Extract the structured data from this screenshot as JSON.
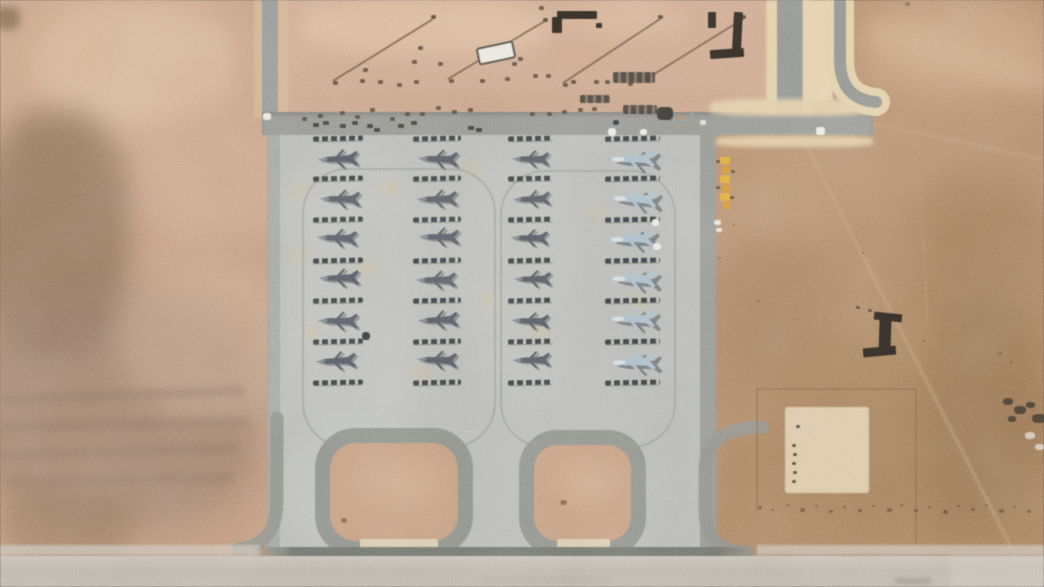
{
  "scene": {
    "width": 1044,
    "height": 587,
    "kind": "satellite-photo",
    "description": "Overhead satellite view of a desert airbase: a light-gray concrete apron holds four columns of six parked fighter jets (three columns of dark-gray jets, one column of light blue-gray jets), each with dark tie-down strips between rows; two rounded loop taxiways at the bottom; access roads and a dirt vehicle yard at top; open desert terrain around; runway band along the bottom edge.",
    "aircraft_total": 24,
    "aircraft_rows": 6,
    "aircraft_columns": 4
  },
  "palette": {
    "desert_left": "#c69b7c",
    "desert_right": "#ab7f5d",
    "dirt_yard": "#cfa487",
    "apron": "#b6b9b5",
    "apron_edge": "#8f928d",
    "road": "#8f918d",
    "road_cream": "#e4cfa4",
    "loop_ring": "#898c86",
    "loop_dirt": "#c59a79",
    "strip": "#2d3034",
    "jet_dark": "#4d545e",
    "jet_light": "#a8bccb",
    "runway_band": "#bab4a9",
    "crane_yellow": "#e0a82e"
  },
  "terrain": {
    "patches": [
      [
        30,
        0,
        210,
        130,
        "#d8b795",
        14,
        0.75,
        "45%"
      ],
      [
        140,
        110,
        150,
        130,
        "#cfa98a",
        16,
        0.6,
        "45%"
      ],
      [
        -20,
        110,
        150,
        250,
        "#7e604b",
        14,
        0.7,
        "40%"
      ],
      [
        -30,
        290,
        290,
        240,
        "#8f7260",
        18,
        0.65,
        "40%"
      ],
      [
        120,
        260,
        170,
        160,
        "#c9a688",
        14,
        0.55,
        "45%"
      ],
      [
        0,
        495,
        130,
        70,
        "#8a6a52",
        12,
        0.5,
        "40%"
      ],
      [
        -6,
        6,
        26,
        24,
        "#6f543f",
        4,
        0.7,
        "40%"
      ],
      [
        860,
        0,
        190,
        95,
        "#d0a77f",
        16,
        0.65,
        "45%"
      ],
      [
        910,
        170,
        140,
        170,
        "#96704f",
        18,
        0.5,
        "45%"
      ],
      [
        700,
        240,
        130,
        140,
        "#9f775a",
        16,
        0.45,
        "45%"
      ],
      [
        920,
        300,
        130,
        230,
        "#8d6949",
        18,
        0.5,
        "45%"
      ],
      [
        748,
        150,
        120,
        90,
        "#b8906d",
        12,
        0.5,
        "45%"
      ]
    ],
    "streaks": [
      [
        0,
        395,
        245,
        9,
        "#84695a",
        -2,
        4,
        0.5
      ],
      [
        0,
        423,
        250,
        8,
        "#84695a",
        -1,
        4,
        0.5
      ],
      [
        0,
        452,
        240,
        8,
        "#84695a",
        -2,
        4,
        0.45
      ],
      [
        8,
        478,
        225,
        8,
        "#84695a",
        -1,
        4,
        0.4
      ],
      [
        868,
        18,
        230,
        24,
        "#d7af88",
        16,
        10,
        0.55
      ]
    ],
    "tracks": [
      [
        806,
        143,
        473,
        63,
        2.5,
        "#c5a07c",
        0.5
      ],
      [
        918,
        140,
        182,
        87,
        2,
        "#b89271",
        0.4
      ],
      [
        873,
        122,
        172,
        12,
        3,
        "#c3a37e",
        0.35
      ]
    ],
    "speckles": [
      [
        712,
        242,
        3
      ],
      [
        718,
        257,
        3
      ],
      [
        709,
        269,
        2
      ],
      [
        757,
        300,
        3
      ],
      [
        733,
        224,
        2
      ],
      [
        905,
        2,
        5
      ],
      [
        922,
        340,
        3
      ],
      [
        862,
        252,
        2
      ],
      [
        998,
        352,
        4
      ],
      [
        1010,
        361,
        3
      ]
    ]
  },
  "yard": {
    "rect": [
      285,
      0,
      481,
      112
    ],
    "color": "#cfa487",
    "light_patches": [
      [
        300,
        0,
        250,
        55,
        "#e2c09e",
        10,
        0.7
      ],
      [
        560,
        0,
        130,
        40,
        "#dbb391",
        8,
        0.55
      ],
      [
        285,
        92,
        480,
        22,
        "#b98f70",
        8,
        0.35
      ]
    ],
    "lines": [
      [
        333,
        80,
        117,
        -31.8
      ],
      [
        448,
        78,
        113,
        -30.9
      ],
      [
        563,
        82,
        116,
        -33.4
      ],
      [
        643,
        80,
        118,
        -31.8
      ]
    ],
    "line_color": "#6a4f39",
    "line_end_dots": [
      [
        431,
        15
      ],
      [
        543,
        18
      ],
      [
        658,
        15
      ],
      [
        741,
        15
      ]
    ],
    "dots": [
      [
        333,
        81
      ],
      [
        360,
        79
      ],
      [
        378,
        80
      ],
      [
        397,
        83
      ],
      [
        414,
        80
      ],
      [
        449,
        79
      ],
      [
        480,
        79
      ],
      [
        505,
        77
      ],
      [
        563,
        83
      ],
      [
        571,
        80
      ],
      [
        594,
        80
      ],
      [
        605,
        80
      ],
      [
        628,
        82
      ],
      [
        412,
        60
      ],
      [
        418,
        46
      ],
      [
        438,
        62
      ],
      [
        363,
        68
      ],
      [
        512,
        62
      ],
      [
        518,
        57
      ],
      [
        533,
        74
      ],
      [
        546,
        74
      ],
      [
        302,
        117
      ],
      [
        318,
        114
      ],
      [
        340,
        111
      ],
      [
        355,
        115
      ],
      [
        370,
        108
      ],
      [
        390,
        117
      ],
      [
        405,
        112
      ],
      [
        420,
        112
      ],
      [
        436,
        106
      ],
      [
        452,
        110
      ],
      [
        468,
        108
      ],
      [
        530,
        112
      ],
      [
        547,
        112
      ],
      [
        562,
        110
      ],
      [
        578,
        108
      ],
      [
        592,
        107
      ],
      [
        539,
        6
      ]
    ],
    "white_vehicle": {
      "x": 477,
      "y": 44,
      "w": 34,
      "h": 14,
      "rot": -12
    },
    "equip_rows": [
      [
        580,
        95,
        30,
        8
      ],
      [
        623,
        105,
        34,
        9
      ],
      [
        613,
        72,
        42,
        11
      ]
    ],
    "dark_blob": [
      657,
      107,
      16,
      13
    ],
    "color_dots": [
      [
        680,
        116,
        "#d27c3a",
        4
      ],
      [
        690,
        113,
        "#9a948c",
        4
      ],
      [
        700,
        120,
        "#e7e4dc",
        6
      ],
      [
        677,
        126,
        "#d8b430",
        3
      ],
      [
        685,
        127,
        "#cf7a36",
        3
      ]
    ],
    "brackets": [
      [
        [
          557,
          11,
          40,
          8,
          0
        ],
        [
          552,
          17,
          10,
          16,
          0
        ],
        [
          596,
          23,
          6,
          5,
          0
        ]
      ],
      [
        [
          733,
          12,
          9,
          38,
          3
        ],
        [
          710,
          49,
          34,
          9,
          -4
        ],
        [
          708,
          12,
          8,
          16,
          0
        ]
      ]
    ],
    "bracket_color": "#26211a"
  },
  "roads": {
    "left_vertical_cream": [
      254,
      0,
      34,
      118
    ],
    "left_vertical_gray": [
      262,
      0,
      16,
      116
    ],
    "horizontal": [
      262,
      112,
      611,
      23
    ],
    "right1_cream": [
      766,
      0,
      46,
      114
    ],
    "right1_gray": [
      777,
      0,
      26,
      118
    ],
    "cream_mid": [
      803,
      0,
      30,
      102
    ],
    "cream_above": [
      710,
      99,
      163,
      17
    ],
    "cream_below": [
      716,
      136,
      157,
      11
    ],
    "white_dots": [
      [
        263,
        113,
        8,
        7
      ],
      [
        816,
        127,
        9,
        8
      ]
    ]
  },
  "apron": {
    "rect": [
      270,
      135,
      446,
      420
    ],
    "left_edge": [
      267,
      135,
      13,
      420
    ],
    "right_edge": [
      700,
      135,
      16,
      420
    ],
    "light_patches": [
      [
        288,
        140,
        130,
        300,
        "#c1c4bf",
        12,
        0.5
      ],
      [
        470,
        150,
        100,
        270,
        "#bfc2bd",
        12,
        0.45
      ],
      [
        286,
        425,
        150,
        125,
        "#c2c5c0",
        12,
        0.5
      ],
      [
        640,
        380,
        70,
        170,
        "#b0b3ae",
        10,
        0.4
      ]
    ],
    "warm_spots": [
      [
        300,
        190
      ],
      [
        390,
        188
      ],
      [
        368,
        268
      ],
      [
        300,
        255
      ],
      [
        472,
        168
      ],
      [
        596,
        213
      ],
      [
        640,
        300
      ],
      [
        420,
        372
      ],
      [
        540,
        332
      ],
      [
        310,
        332
      ],
      [
        488,
        300
      ]
    ],
    "warm_color": "#d9b87e",
    "guidelines": [
      [
        302,
        168,
        190,
        276,
        45
      ],
      [
        500,
        170,
        172,
        274,
        45
      ]
    ]
  },
  "paths": [
    [
      "M840,-6 L840,60 Q840,99 876,102",
      "#e4cfa4",
      28,
      1
    ],
    [
      "M840,-6 L840,60 Q840,99 876,102",
      "#8c8f8b",
      12,
      1
    ],
    [
      "M277,418 L277,500 Q277,546 238,549",
      "#898c86",
      13,
      0.95
    ],
    [
      "M762,427 Q705,428 705,470 L705,510 Q705,551 748,553",
      "#898c86",
      13,
      0.9
    ]
  ],
  "loops": {
    "ring_color": "#898c86",
    "dirt_color": "#c59a79",
    "notch_color": "#d9cbac",
    "items": [
      {
        "outer": [
          315,
          428,
          158,
          128
        ],
        "radius": 40,
        "ring": 15,
        "notch": [
          360,
          539,
          78,
          17
        ]
      },
      {
        "outer": [
          519,
          430,
          127,
          126
        ],
        "radius": 38,
        "ring": 15,
        "notch": [
          557,
          539,
          53,
          17
        ]
      }
    ],
    "dirt_specks": [
      [
        341,
        518,
        6,
        5
      ],
      [
        560,
        500,
        7,
        5
      ]
    ]
  },
  "aircraft": {
    "columns": [
      {
        "cx": 338,
        "kind": "dark",
        "w": 42,
        "h": 26,
        "sw": 50
      },
      {
        "cx": 437,
        "kind": "dark",
        "w": 42,
        "h": 26,
        "sw": 48
      },
      {
        "cx": 530,
        "kind": "dark",
        "w": 39,
        "h": 24,
        "sw": 45
      },
      {
        "cx": 632,
        "kind": "light",
        "w": 52,
        "h": 28,
        "sw": 55
      }
    ],
    "row_cy": [
      159,
      198,
      238,
      279,
      320,
      361
    ],
    "strip_y": [
      136,
      176,
      217,
      258,
      298,
      339,
      380
    ],
    "jitter": [
      [
        0,
        0,
        -2
      ],
      [
        2,
        1,
        1
      ],
      [
        -1,
        0,
        2
      ],
      [
        1,
        -1,
        -1
      ],
      [
        0,
        1,
        1
      ],
      [
        -2,
        0,
        -2
      ],
      [
        1,
        0,
        2
      ],
      [
        0,
        1,
        -1
      ],
      [
        2,
        -1,
        1
      ],
      [
        -1,
        1,
        0
      ],
      [
        1,
        0,
        -2
      ],
      [
        0,
        -1,
        2
      ],
      [
        0,
        0,
        1
      ],
      [
        1,
        1,
        -2
      ],
      [
        -1,
        0,
        1
      ],
      [
        2,
        0,
        0
      ],
      [
        0,
        1,
        2
      ],
      [
        1,
        -1,
        -1
      ],
      [
        0,
        0,
        -1
      ],
      [
        2,
        1,
        2
      ],
      [
        -1,
        1,
        -2
      ],
      [
        1,
        0,
        1
      ],
      [
        0,
        -1,
        0
      ],
      [
        1,
        1,
        -2
      ]
    ],
    "white_blobs": [
      [
        608,
        128,
        8,
        8
      ],
      [
        640,
        129,
        7,
        6
      ],
      [
        652,
        219,
        7,
        7
      ],
      [
        653,
        243,
        8,
        7
      ]
    ],
    "dark_dots": [
      [
        362,
        332,
        8,
        8
      ],
      [
        613,
        120,
        6,
        5
      ]
    ],
    "road_vehicles": [
      [
        313,
        123
      ],
      [
        323,
        121
      ],
      [
        340,
        124
      ],
      [
        352,
        121
      ],
      [
        367,
        124
      ],
      [
        374,
        128
      ],
      [
        398,
        124
      ],
      [
        411,
        121
      ],
      [
        468,
        126
      ],
      [
        476,
        128
      ]
    ],
    "gray_dashes": [
      [
        668,
        124
      ],
      [
        677,
        127
      ],
      [
        686,
        124
      ]
    ]
  },
  "right_area": {
    "i_structure": {
      "bars": [
        [
          874,
          313,
          28,
          8,
          6
        ],
        [
          879,
          319,
          12,
          32,
          2
        ],
        [
          863,
          347,
          33,
          9,
          -5
        ]
      ],
      "specks": [
        [
          856,
          306
        ],
        [
          868,
          309
        ]
      ]
    },
    "crane": {
      "segs": [
        [
          720,
          157,
          10,
          7,
          "#e3aa2e"
        ],
        [
          722,
          166,
          8,
          7,
          "#d8912a"
        ],
        [
          720,
          175,
          10,
          8,
          "#e3aa2e"
        ],
        [
          722,
          185,
          8,
          7,
          "#d8912a"
        ],
        [
          720,
          193,
          10,
          8,
          "#e3aa2e"
        ],
        [
          723,
          202,
          7,
          7,
          "#d8912a"
        ]
      ],
      "marks": [
        [
          716,
          160
        ],
        [
          731,
          170
        ],
        [
          716,
          186
        ],
        [
          730,
          196
        ]
      ],
      "white_dots": [
        [
          714,
          220,
          7,
          5
        ],
        [
          716,
          228,
          6,
          4
        ]
      ]
    },
    "compound": {
      "boundary_h": [
        756,
        388,
        160
      ],
      "boundary_v1": [
        756,
        388,
        122
      ],
      "boundary_v2": [
        915,
        388,
        158
      ],
      "pad": [
        785,
        407,
        84,
        86
      ],
      "pad_color": "#dfc8a4",
      "pad_dots": [
        [
          792,
          444
        ],
        [
          793,
          453
        ],
        [
          792,
          462
        ],
        [
          793,
          471
        ],
        [
          792,
          480
        ],
        [
          796,
          425
        ]
      ]
    },
    "scrub": [
      [
        758,
        506,
        4
      ],
      [
        771,
        509,
        3
      ],
      [
        786,
        504,
        3
      ],
      [
        800,
        508,
        5
      ],
      [
        815,
        505,
        3
      ],
      [
        829,
        510,
        4
      ],
      [
        843,
        506,
        3
      ],
      [
        858,
        509,
        4
      ],
      [
        872,
        505,
        3
      ],
      [
        887,
        508,
        5
      ],
      [
        900,
        504,
        3
      ],
      [
        914,
        509,
        4
      ],
      [
        928,
        506,
        3
      ],
      [
        943,
        510,
        5
      ],
      [
        957,
        505,
        3
      ],
      [
        971,
        508,
        4
      ],
      [
        985,
        504,
        3
      ],
      [
        999,
        509,
        5
      ],
      [
        1013,
        506,
        3
      ],
      [
        1027,
        510,
        4
      ]
    ],
    "dark_cluster": [
      [
        1003,
        398,
        10,
        7
      ],
      [
        1014,
        406,
        12,
        8
      ],
      [
        1026,
        402,
        9,
        6
      ],
      [
        1008,
        416,
        8,
        6
      ],
      [
        1032,
        414,
        14,
        9
      ]
    ],
    "light_cluster": [
      [
        1025,
        432,
        10,
        7
      ],
      [
        1035,
        444,
        9,
        6
      ]
    ]
  },
  "bottom": {
    "dark_line": [
      252,
      547,
      505,
      9
    ],
    "band": [
      0,
      556,
      1044,
      31
    ],
    "band_color": "#bab4a9",
    "side_lines": [
      [
        0,
        545,
        260,
        10
      ],
      [
        757,
        545,
        287,
        10
      ]
    ],
    "smudges": [
      [
        480,
        577,
        130,
        7,
        "#a9a49a",
        3,
        0.55
      ],
      [
        895,
        578,
        36,
        6,
        "#8e897f",
        2,
        0.7
      ]
    ],
    "light_corner": [
      950,
      556,
      94,
      31
    ]
  }
}
